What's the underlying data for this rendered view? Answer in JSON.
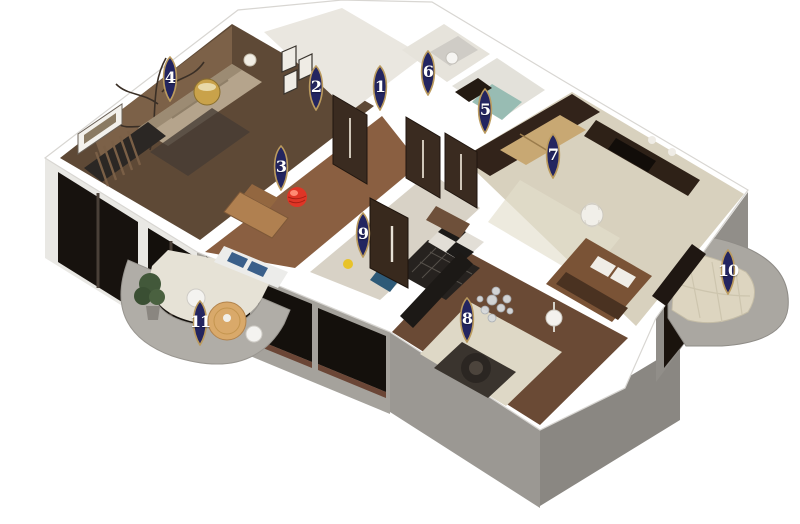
{
  "scene": {
    "description": "3D isometric apartment floor plan render with numbered location pins",
    "background": "#ffffff",
    "marker_style": {
      "fill": "#232560",
      "border": "#bb9b5e",
      "text_color": "#ffffff"
    }
  },
  "markers": [
    {
      "label": "1",
      "x": 380,
      "y": 88
    },
    {
      "label": "2",
      "x": 316,
      "y": 88
    },
    {
      "label": "3",
      "x": 281,
      "y": 168
    },
    {
      "label": "4",
      "x": 170,
      "y": 79
    },
    {
      "label": "5",
      "x": 485,
      "y": 111
    },
    {
      "label": "6",
      "x": 428,
      "y": 73
    },
    {
      "label": "7",
      "x": 553,
      "y": 156
    },
    {
      "label": "8",
      "x": 467,
      "y": 320
    },
    {
      "label": "9",
      "x": 363,
      "y": 235
    },
    {
      "label": "10",
      "x": 728,
      "y": 272
    },
    {
      "label": "11",
      "x": 200,
      "y": 323
    }
  ]
}
